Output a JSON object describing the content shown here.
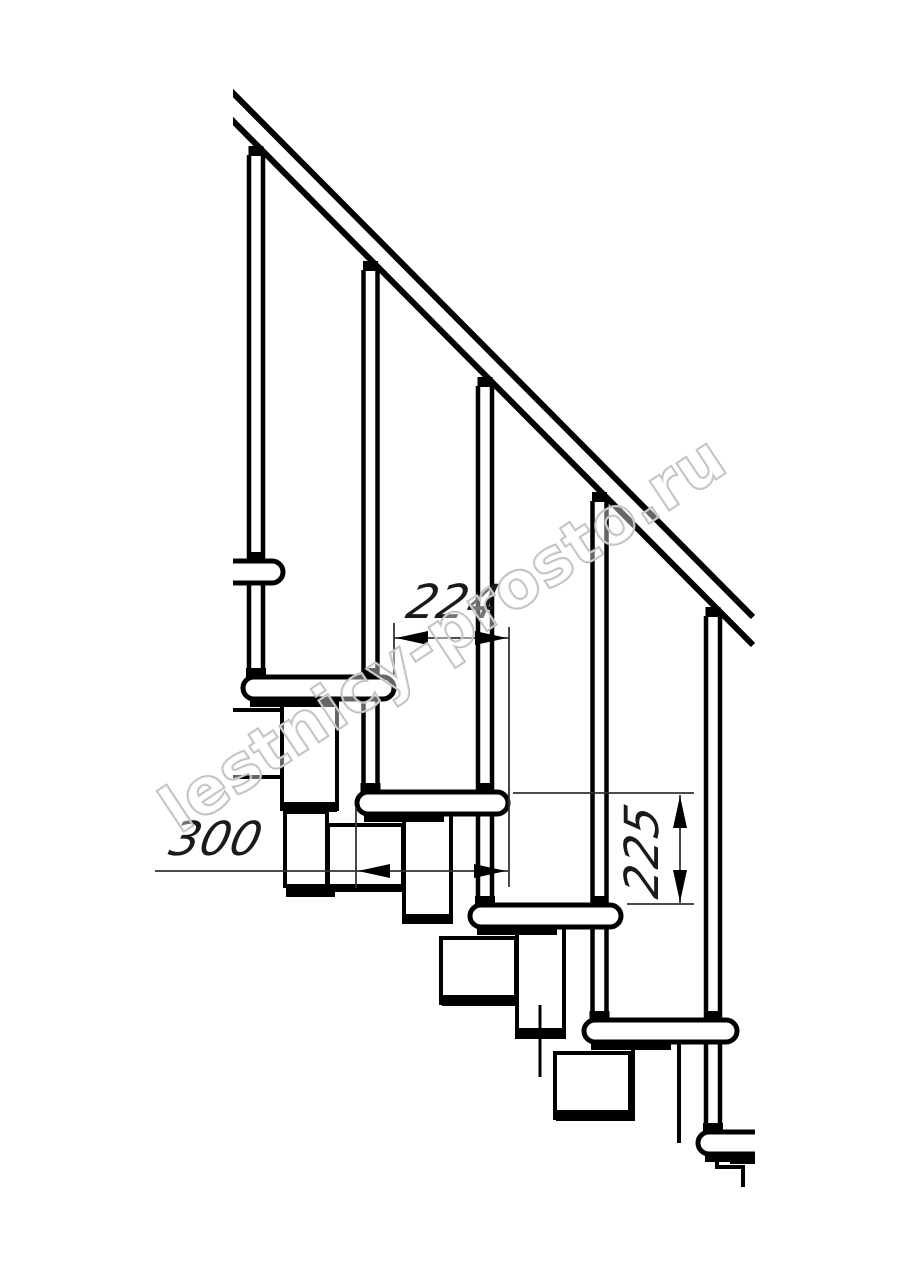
{
  "drawing": {
    "dimensions": {
      "run": "224",
      "depth": "300",
      "rise": "225"
    },
    "watermark": "lestnicy-prosto.ru"
  },
  "colors": {
    "line": "#000000",
    "watermark_outline": "#b9b9b9",
    "background": "#ffffff"
  }
}
